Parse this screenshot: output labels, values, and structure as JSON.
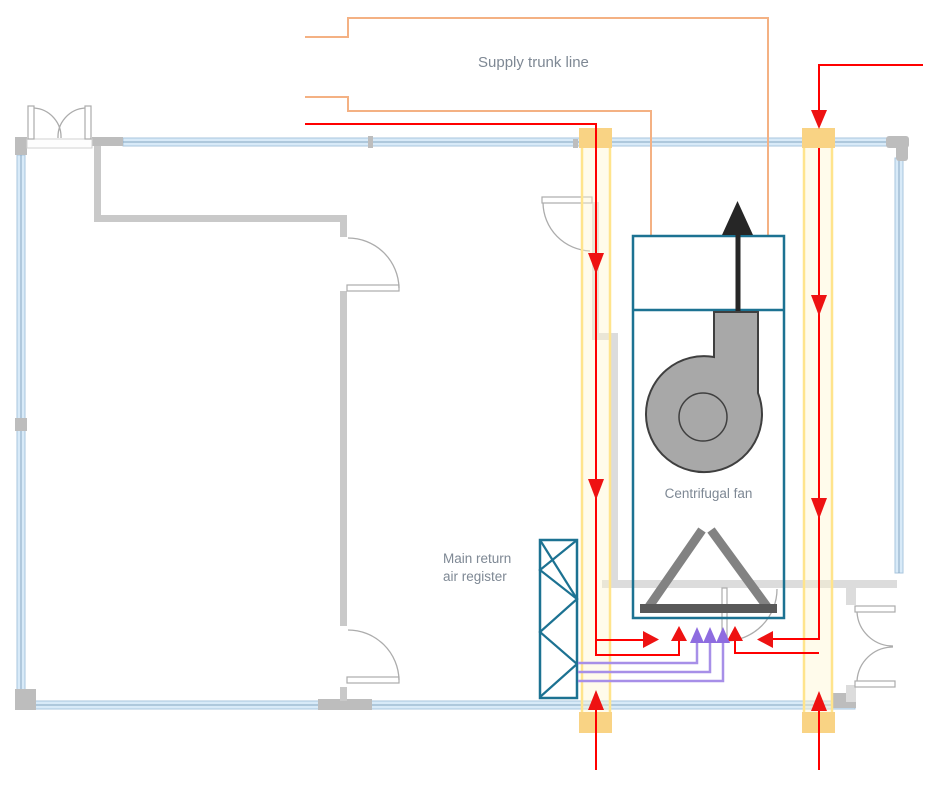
{
  "labels": {
    "supply_trunk": "Supply trunk line",
    "centrifugal_fan": "Centrifugal fan",
    "main_return_line1": "Main return",
    "main_return_line2": "air register"
  },
  "colors": {
    "wall_fill": "#D8EAF8",
    "wall_edge": "#A9C6DE",
    "wall_mid": "#7FA0BC",
    "wall_block": "#BDBDBD",
    "interior_wall": "#C9C9C9",
    "interior_wall_light": "#DCDCDC",
    "door_line": "#ACACAC",
    "duct_line": "#FFE48C",
    "duct_fill": "rgba(255,244,205,0.40)",
    "duct_conn": "#F9D384",
    "trunk": "#F4B183",
    "equip": "#1C7292",
    "fan_fill": "#A8A8A8",
    "fan_stroke": "#3F3F3F",
    "filter_bar": "#828282",
    "filter_base": "#595959",
    "exhaust": "#262626",
    "supply": "#FF0000",
    "supply_arrow": "#EE1212",
    "return_line": "#A78FE8",
    "return_arrow": "#8E6CE0",
    "label_text": "#7E8894"
  }
}
